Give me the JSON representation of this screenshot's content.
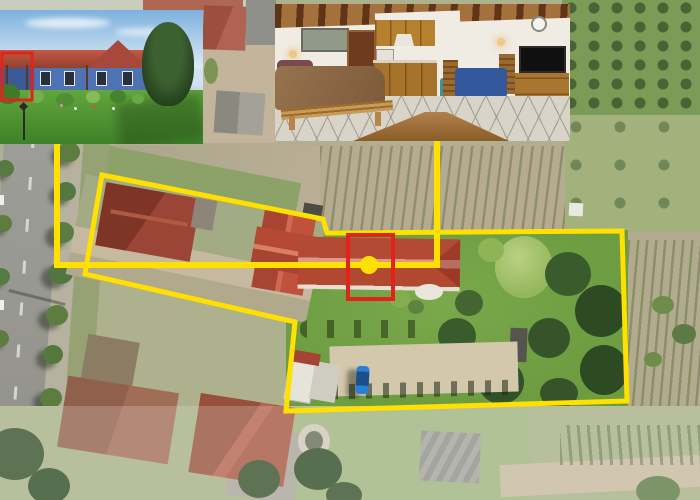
{
  "scene": {
    "type": "real-estate-aerial-composite",
    "description": "Aerial view of a village plot: yellow boundary around the property, red rectangle highlighting the for-sale building section with a yellow location dot, connector lines leading to two photo insets",
    "insets": {
      "exterior_photo": "blue single-storey house with red tiled roof, lawn, flower bushes and tall conifer",
      "interior_photo": "studio apartment with double bed, wooden beam ceiling, kitchenette, blue dining table and TV cabinet"
    },
    "map_features": {
      "left": "tree-lined asphalt street with sidewalk",
      "top": "ploughed field with crop rows",
      "right": "green scrub field and garden allotments",
      "center": "red-roofed houses and long red-roofed wing inside boundary, large garden with trees, gravel parking with blue car",
      "bottom": "neighbouring houses, pond, barn roof and dirt track"
    }
  },
  "colors": {
    "annotation_yellow": "#FFE000",
    "annotation_red": "#E2231A"
  },
  "overlay": {
    "boundary_points": "102,175 323,219 327,233 622,231 627,401 286,411 295,322 85,274",
    "connector_points": "437,141 437,265 57,265 57,144",
    "marker": {
      "cx": "369",
      "cy": "265",
      "r": "9"
    },
    "map_highlight": {
      "x": "348",
      "y": "235",
      "w": "45",
      "h": "64"
    },
    "inset_highlight": {
      "x": "2",
      "y": "53",
      "w": "30",
      "h": "47"
    }
  }
}
